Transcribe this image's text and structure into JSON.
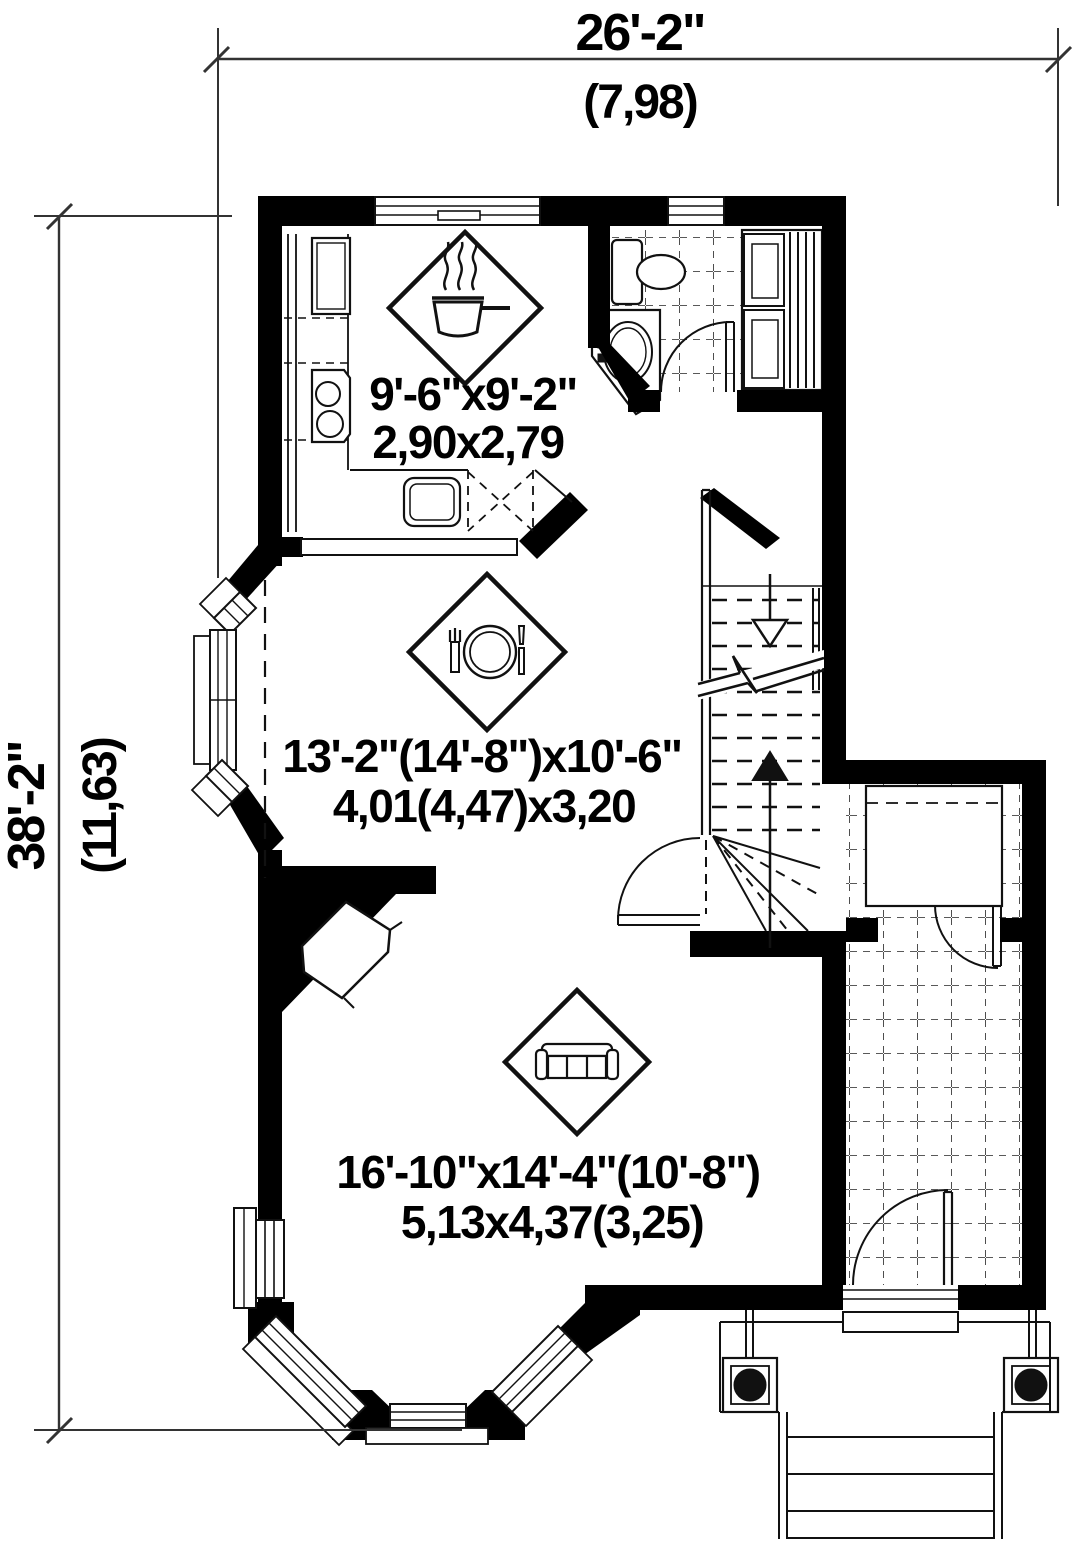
{
  "plan": {
    "title": "house first floor plan",
    "dimensions": {
      "top": {
        "feet": "26'-2\"",
        "meters": "(7,98)"
      },
      "left": {
        "feet": "38'-2\"",
        "meters": "(11,63)"
      }
    },
    "rooms": [
      {
        "id": "kitchen",
        "feet": "9'-6\"x9'-2\"",
        "meters": "2,90x2,79",
        "icon": "cooking-pot-icon"
      },
      {
        "id": "dining-room",
        "feet": "13'-2\"(14'-8\")x10'-6\"",
        "meters": "4,01(4,47)x3,20",
        "icon": "dining-plate-icon"
      },
      {
        "id": "living-room",
        "feet": "16'-10\"x14'-4\"(10'-8\")",
        "meters": "5,13x4,37(3,25)",
        "icon": "sofa-icon"
      }
    ],
    "colors": {
      "walls": "#000000",
      "lines": "#1a1a1a",
      "background": "#ffffff"
    }
  }
}
